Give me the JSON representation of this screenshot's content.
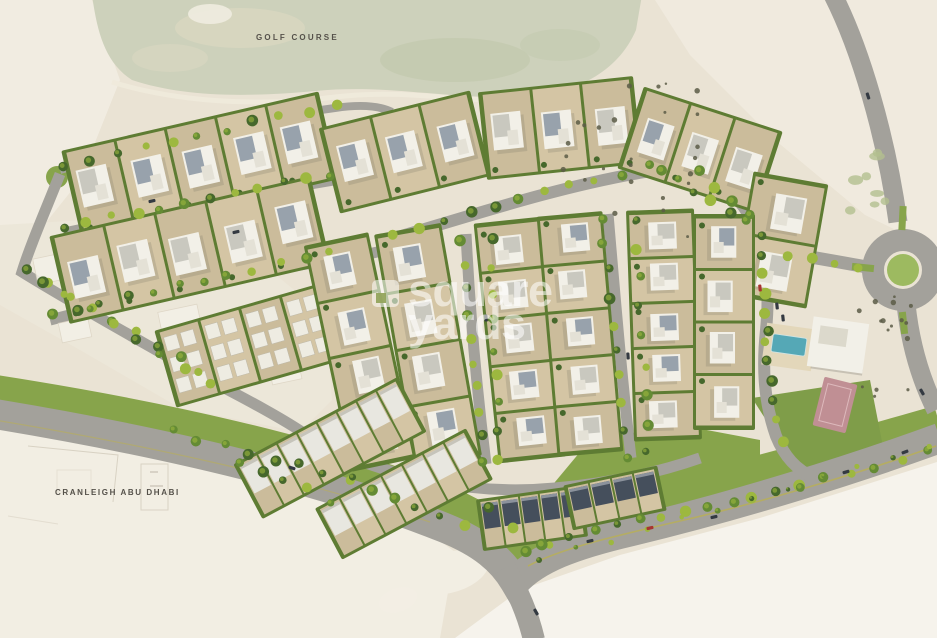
{
  "labels": {
    "golf_course": "GOLF COURSE",
    "school": "CRANLEIGH ABU DHABI"
  },
  "watermark": {
    "line1": "square",
    "line2": "yards",
    "logo_icon": "square-yards-notched-square"
  },
  "colors": {
    "sand": "#eae3d4",
    "sand_light": "#f2eee3",
    "sand_bright": "#f6f3ec",
    "sand_ghost": "#ece7d9",
    "golf": "#cdd1bb",
    "golf_patch_light": "#dad7c1",
    "golf_patch_dark": "#c2c9ad",
    "cart_path": "#efeadc",
    "road": "#a3a19b",
    "green_buffer": "#87a44b",
    "green_lawn": "#7f9d49",
    "hedge": "#5e7c33",
    "tree_dark": "#46682c",
    "tree_mid": "#648b34",
    "tree_light": "#9db83f",
    "plot": "#d4c5a4",
    "plot_alt": "#cbbc9b",
    "villa_wall": "#f2f0e8",
    "roof_gray": "#c9c8bf",
    "roof_slate": "#98a2ac",
    "town_roof": "#e8e7e0",
    "town_roof_dark": "#454f5c",
    "pool": "#55a8b6",
    "court": "#c08f94",
    "median": "#b5ad62",
    "shrub": "#5c5c46",
    "tuft": "#b3bf8e",
    "outline": "#d6cfc0",
    "roundabout_green": "#9dba60",
    "label_text": "#55514a",
    "watermark_white": "rgba(255,255,255,0.55)"
  }
}
